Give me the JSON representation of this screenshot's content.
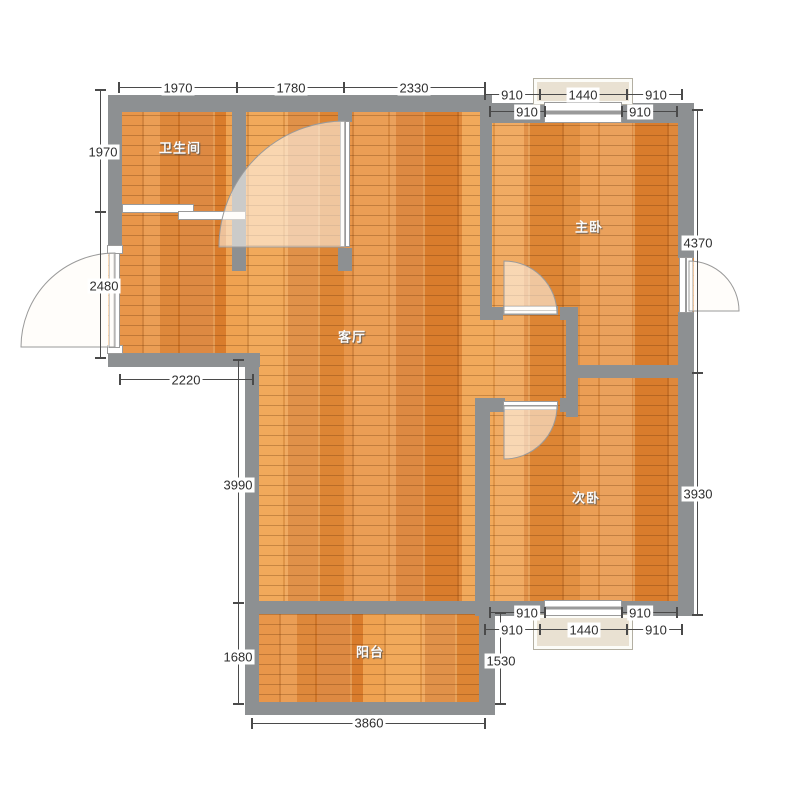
{
  "rooms": [
    {
      "id": "bathroom",
      "name": "卫生间"
    },
    {
      "id": "master-bedroom",
      "name": "主卧"
    },
    {
      "id": "living-room",
      "name": "客厅"
    },
    {
      "id": "second-bedroom",
      "name": "次卧"
    },
    {
      "id": "balcony",
      "name": "阳台"
    }
  ],
  "dimensions": {
    "top": [
      "1970",
      "1780",
      "2330"
    ],
    "left": [
      "1970",
      "2480"
    ],
    "entry_bottom": "2220",
    "living_left": "3990",
    "balcony_left": "1680",
    "balcony_bottom": "3860",
    "balcony_right": "1530",
    "right_upper": "4370",
    "right_lower": "3930",
    "top_right_outer": [
      "910",
      "1440",
      "910"
    ],
    "top_right_inner": [
      "910",
      "910"
    ],
    "bottom_right_outer": [
      "910",
      "1440",
      "910"
    ],
    "bottom_right_inner": [
      "910",
      "910"
    ]
  },
  "colors": {
    "wall": "#8d9092",
    "floor_base": "#e08a3a",
    "window_bay_fill": "#e9e1d2",
    "dim_text": "#2e2e2e",
    "room_label_text": "#fafafa"
  }
}
